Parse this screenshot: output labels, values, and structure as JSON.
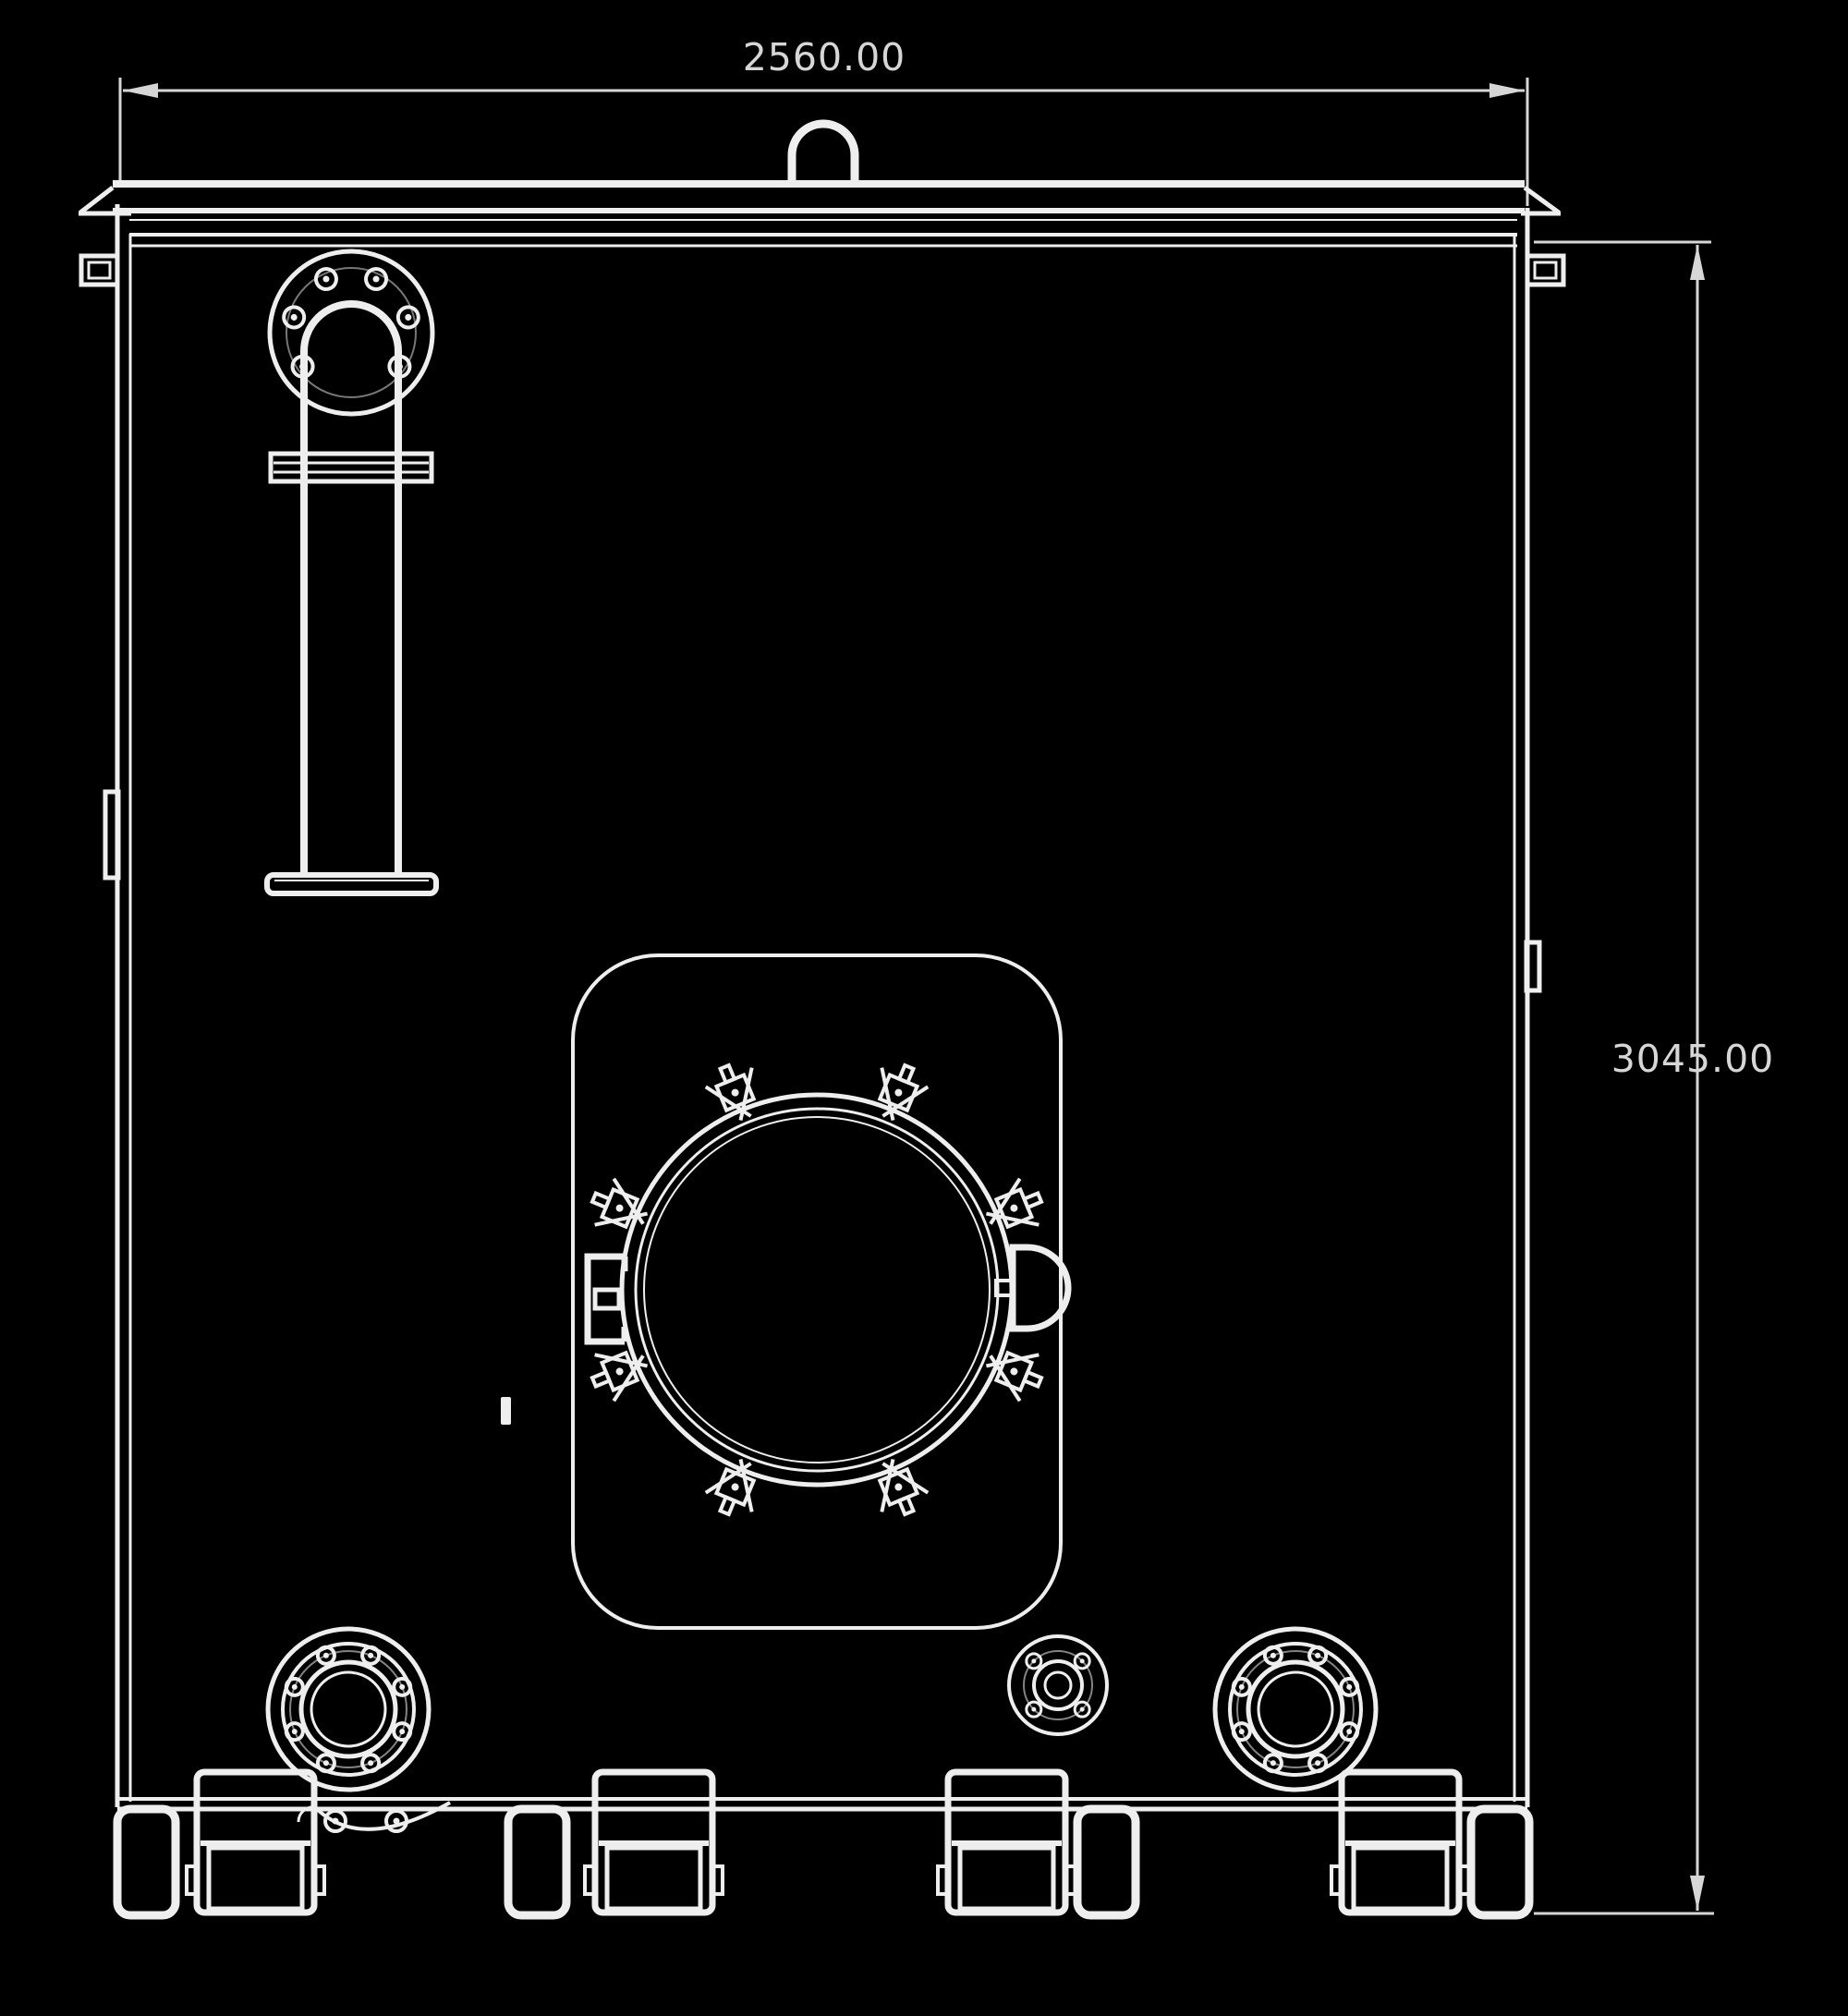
{
  "drawing": {
    "background": "#000000",
    "line_color": "#eeeeee",
    "dim_color": "#d6d6d6",
    "dimensions": {
      "width_label": "2560.00",
      "height_label": "3045.00"
    }
  }
}
